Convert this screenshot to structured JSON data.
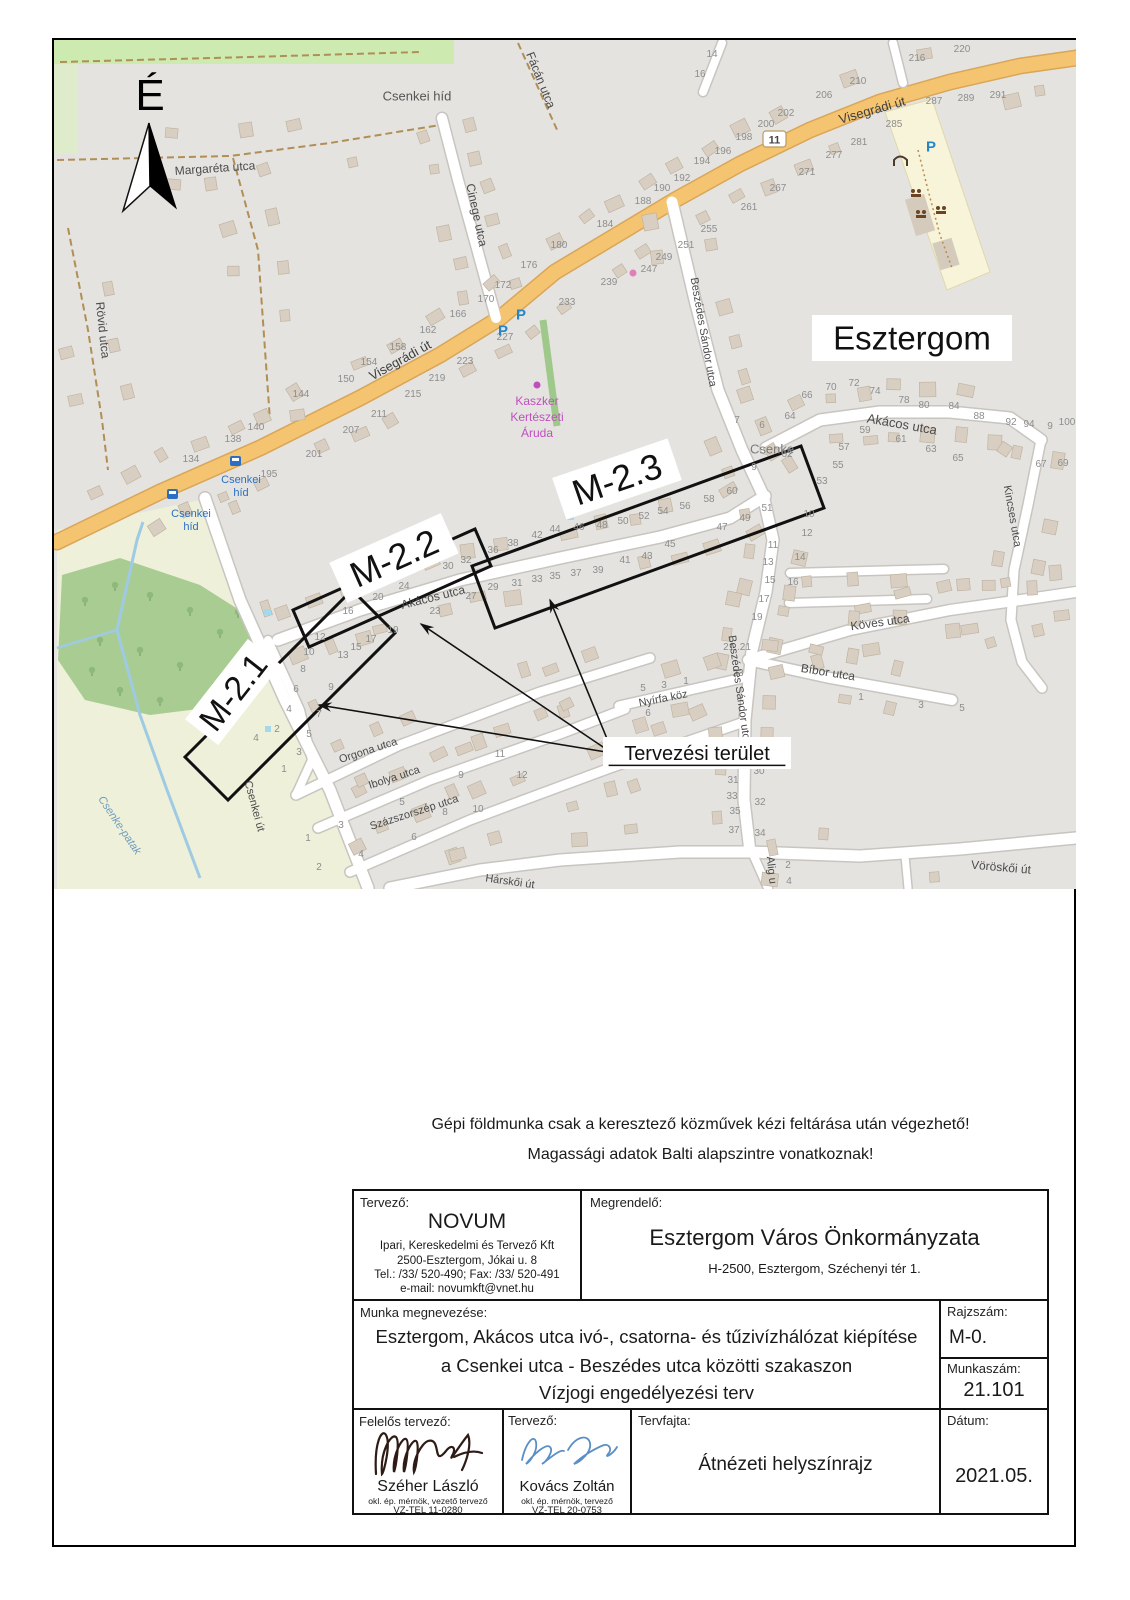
{
  "page": {
    "north_symbol": "É",
    "note_line1": "Gépi földmunka csak a keresztező közművek kézi feltárása után végezhető!",
    "note_line2": "Magassági adatok Balti alapszintre vonatkoznak!"
  },
  "map": {
    "route_shield": "11",
    "city_label": "Esztergom",
    "planning_area_label": "Tervezési terület",
    "section_labels": [
      "M-2.1",
      "M-2.2",
      "M-2.3"
    ],
    "labels": [
      {
        "t": "Margaréta utca",
        "x": 215,
        "y": 168,
        "r": -4,
        "s": 12
      },
      {
        "t": "Cinege utca",
        "x": 477,
        "y": 215,
        "r": 78,
        "s": 12
      },
      {
        "t": "Fácán utca",
        "x": 541,
        "y": 80,
        "r": 68,
        "s": 12
      },
      {
        "t": "Rövid utca",
        "x": 103,
        "y": 330,
        "r": 84,
        "s": 12
      },
      {
        "t": "Visegrádi út",
        "x": 400,
        "y": 360,
        "r": -29,
        "s": 13,
        "c": "#3f3f3f"
      },
      {
        "t": "Visegrádi út",
        "x": 872,
        "y": 110,
        "r": -16,
        "s": 13,
        "c": "#3f3f3f"
      },
      {
        "t": "Csenkei híd",
        "x": 417,
        "y": 96,
        "r": 0,
        "s": 13,
        "c": "#555"
      },
      {
        "t": "Akácos utca",
        "x": 433,
        "y": 597,
        "r": -14,
        "s": 12
      },
      {
        "t": "Akácos utca",
        "x": 902,
        "y": 424,
        "r": 10,
        "s": 13
      },
      {
        "t": "Beszédes Sándor utca",
        "x": 704,
        "y": 332,
        "r": 80,
        "s": 11
      },
      {
        "t": "Beszédes Sándor utca",
        "x": 740,
        "y": 690,
        "r": 82,
        "s": 11
      },
      {
        "t": "Kincses utca",
        "x": 1013,
        "y": 516,
        "r": 80,
        "s": 11
      },
      {
        "t": "Köves utca",
        "x": 880,
        "y": 622,
        "r": -8,
        "s": 12
      },
      {
        "t": "Bíbor utca",
        "x": 828,
        "y": 672,
        "r": 9,
        "s": 12
      },
      {
        "t": "Nyírfa köz",
        "x": 663,
        "y": 698,
        "r": -11,
        "s": 11
      },
      {
        "t": "Orgona utca",
        "x": 368,
        "y": 750,
        "r": -18,
        "s": 11
      },
      {
        "t": "Ibolya utca",
        "x": 394,
        "y": 777,
        "r": -18,
        "s": 11
      },
      {
        "t": "Százszorszép utca",
        "x": 414,
        "y": 812,
        "r": -18,
        "s": 11
      },
      {
        "t": "Csenkei út",
        "x": 255,
        "y": 806,
        "r": 75,
        "s": 11
      },
      {
        "t": "Vöröskői út",
        "x": 1001,
        "y": 867,
        "r": 5,
        "s": 12
      },
      {
        "t": "Hárskői út",
        "x": 510,
        "y": 881,
        "r": 8,
        "s": 11
      },
      {
        "t": "Alig u",
        "x": 772,
        "y": 870,
        "r": 84,
        "s": 11
      },
      {
        "t": "Csenke",
        "x": 772,
        "y": 449,
        "r": 0,
        "s": 13,
        "c": "#7a7a7a"
      },
      {
        "t": "Csenke-patak",
        "x": 120,
        "y": 825,
        "r": 56,
        "s": 11,
        "c": "#6d9cbd",
        "i": true
      },
      {
        "t": "Kaszker",
        "x": 537,
        "y": 401,
        "s": 12,
        "c": "#bf4fbf"
      },
      {
        "t": "Kertészeti",
        "x": 537,
        "y": 417,
        "s": 12,
        "c": "#bf4fbf"
      },
      {
        "t": "Áruda",
        "x": 537,
        "y": 433,
        "s": 12,
        "c": "#bf4fbf"
      },
      {
        "t": "Csenkei",
        "x": 241,
        "y": 479,
        "s": 11,
        "c": "#2a6fc4"
      },
      {
        "t": "híd",
        "x": 241,
        "y": 492,
        "s": 11,
        "c": "#2a6fc4"
      },
      {
        "t": "Csenkei",
        "x": 191,
        "y": 513,
        "s": 11,
        "c": "#2a6fc4"
      },
      {
        "t": "híd",
        "x": 191,
        "y": 526,
        "s": 11,
        "c": "#2a6fc4"
      },
      {
        "t": "P",
        "x": 503,
        "y": 330,
        "s": 15,
        "c": "#2586c7",
        "b": true
      },
      {
        "t": "P",
        "x": 521,
        "y": 314,
        "s": 15,
        "c": "#2586c7",
        "b": true
      },
      {
        "t": "P",
        "x": 931,
        "y": 146,
        "s": 15,
        "c": "#2586c7",
        "b": true
      },
      {
        "t": "Esztergom",
        "x": 912,
        "y": 338,
        "s": 33,
        "c": "#111",
        "bg": [
          200,
          46
        ]
      },
      {
        "t": "M-2.1",
        "x": 233,
        "y": 692,
        "r": -52,
        "s": 34,
        "c": "#111",
        "bg": [
          102,
          42
        ]
      },
      {
        "t": "M-2.2",
        "x": 394,
        "y": 558,
        "r": -24,
        "s": 36,
        "c": "#111",
        "bg": [
          122,
          44
        ]
      },
      {
        "t": "M-2.3",
        "x": 617,
        "y": 479,
        "r": -19,
        "s": 36,
        "c": "#111",
        "bg": [
          122,
          44
        ]
      },
      {
        "t": "Tervezési terület",
        "x": 697,
        "y": 753,
        "s": 20,
        "c": "#111",
        "bg": [
          188,
          32
        ],
        "u": true
      }
    ],
    "house_numbers": [
      [
        "216",
        917,
        61
      ],
      [
        "220",
        962,
        52
      ],
      [
        "210",
        858,
        84
      ],
      [
        "206",
        824,
        98
      ],
      [
        "202",
        786,
        116
      ],
      [
        "200",
        766,
        127
      ],
      [
        "198",
        744,
        140
      ],
      [
        "196",
        723,
        154
      ],
      [
        "194",
        702,
        164
      ],
      [
        "192",
        682,
        181
      ],
      [
        "190",
        662,
        191
      ],
      [
        "188",
        643,
        204
      ],
      [
        "184",
        605,
        227
      ],
      [
        "180",
        559,
        248
      ],
      [
        "176",
        529,
        268
      ],
      [
        "172",
        503,
        288
      ],
      [
        "170",
        486,
        302
      ],
      [
        "166",
        458,
        317
      ],
      [
        "162",
        428,
        333
      ],
      [
        "158",
        398,
        350
      ],
      [
        "154",
        369,
        365
      ],
      [
        "150",
        346,
        382
      ],
      [
        "144",
        301,
        397
      ],
      [
        "140",
        256,
        430
      ],
      [
        "138",
        233,
        442
      ],
      [
        "134",
        191,
        462
      ],
      [
        "287",
        934,
        104
      ],
      [
        "289",
        966,
        101
      ],
      [
        "291",
        998,
        98
      ],
      [
        "285",
        894,
        127
      ],
      [
        "281",
        859,
        145
      ],
      [
        "277",
        834,
        158
      ],
      [
        "271",
        807,
        175
      ],
      [
        "267",
        778,
        191
      ],
      [
        "261",
        749,
        210
      ],
      [
        "255",
        709,
        232
      ],
      [
        "251",
        686,
        248
      ],
      [
        "249",
        664,
        260
      ],
      [
        "247",
        649,
        272
      ],
      [
        "239",
        609,
        285
      ],
      [
        "233",
        567,
        305
      ],
      [
        "227",
        505,
        340
      ],
      [
        "223",
        465,
        364
      ],
      [
        "219",
        437,
        381
      ],
      [
        "215",
        413,
        397
      ],
      [
        "211",
        379,
        417
      ],
      [
        "207",
        351,
        433
      ],
      [
        "201",
        314,
        457
      ],
      [
        "195",
        269,
        477
      ],
      [
        "14",
        712,
        57
      ],
      [
        "16",
        700,
        77
      ],
      [
        "12",
        320,
        640
      ],
      [
        "16",
        348,
        614
      ],
      [
        "20",
        378,
        600
      ],
      [
        "24",
        404,
        589
      ],
      [
        "30",
        448,
        569
      ],
      [
        "32",
        466,
        563
      ],
      [
        "36",
        493,
        553
      ],
      [
        "38",
        513,
        546
      ],
      [
        "42",
        537,
        538
      ],
      [
        "44",
        555,
        532
      ],
      [
        "46",
        579,
        530
      ],
      [
        "48",
        602,
        528
      ],
      [
        "50",
        623,
        524
      ],
      [
        "52",
        644,
        519
      ],
      [
        "54",
        663,
        514
      ],
      [
        "56",
        685,
        509
      ],
      [
        "58",
        709,
        502
      ],
      [
        "60",
        732,
        494
      ],
      [
        "13",
        343,
        658
      ],
      [
        "15",
        356,
        650
      ],
      [
        "17",
        371,
        642
      ],
      [
        "19",
        393,
        633
      ],
      [
        "23",
        435,
        614
      ],
      [
        "27",
        471,
        599
      ],
      [
        "29",
        493,
        590
      ],
      [
        "31",
        517,
        586
      ],
      [
        "33",
        537,
        582
      ],
      [
        "35",
        555,
        579
      ],
      [
        "37",
        576,
        576
      ],
      [
        "39",
        598,
        573
      ],
      [
        "41",
        625,
        563
      ],
      [
        "43",
        647,
        559
      ],
      [
        "45",
        670,
        547
      ],
      [
        "47",
        722,
        530
      ],
      [
        "49",
        745,
        521
      ],
      [
        "51",
        767,
        511
      ],
      [
        "64",
        790,
        419
      ],
      [
        "66",
        807,
        398
      ],
      [
        "70",
        831,
        390
      ],
      [
        "72",
        854,
        386
      ],
      [
        "74",
        875,
        394
      ],
      [
        "78",
        904,
        403
      ],
      [
        "80",
        924,
        408
      ],
      [
        "84",
        954,
        409
      ],
      [
        "88",
        979,
        419
      ],
      [
        "92",
        1011,
        425
      ],
      [
        "94",
        1029,
        427
      ],
      [
        "9",
        1050,
        429
      ],
      [
        "100",
        1067,
        425
      ],
      [
        "6",
        762,
        428
      ],
      [
        "7",
        737,
        423
      ],
      [
        "62",
        787,
        457
      ],
      [
        "9",
        754,
        470
      ],
      [
        "53",
        822,
        484
      ],
      [
        "55",
        838,
        468
      ],
      [
        "57",
        844,
        450
      ],
      [
        "59",
        865,
        433
      ],
      [
        "61",
        901,
        442
      ],
      [
        "63",
        931,
        452
      ],
      [
        "65",
        958,
        461
      ],
      [
        "67",
        1041,
        467
      ],
      [
        "69",
        1063,
        466
      ],
      [
        "10",
        809,
        517
      ],
      [
        "12",
        807,
        536
      ],
      [
        "14",
        800,
        560
      ],
      [
        "16",
        793,
        585
      ],
      [
        "11",
        773,
        548
      ],
      [
        "13",
        768,
        565
      ],
      [
        "15",
        770,
        583
      ],
      [
        "17",
        764,
        602
      ],
      [
        "19",
        757,
        620
      ],
      [
        "21..21",
        737,
        650
      ],
      [
        "23",
        738,
        676
      ],
      [
        "30",
        759,
        774
      ],
      [
        "31",
        733,
        783
      ],
      [
        "33",
        732,
        799
      ],
      [
        "35",
        735,
        814
      ],
      [
        "37",
        734,
        833
      ],
      [
        "32",
        760,
        805
      ],
      [
        "34",
        760,
        836
      ],
      [
        "1",
        861,
        700
      ],
      [
        "3",
        921,
        708
      ],
      [
        "5",
        962,
        711
      ],
      [
        "5",
        643,
        691
      ],
      [
        "3",
        664,
        688
      ],
      [
        "1",
        686,
        684
      ],
      [
        "6",
        648,
        716
      ],
      [
        "10",
        309,
        655
      ],
      [
        "8",
        303,
        672
      ],
      [
        "6",
        296,
        692
      ],
      [
        "9",
        331,
        690
      ],
      [
        "4",
        289,
        712
      ],
      [
        "7",
        319,
        717
      ],
      [
        "2",
        277,
        732
      ],
      [
        "5",
        309,
        737
      ],
      [
        "3",
        299,
        755
      ],
      [
        "1",
        284,
        772
      ],
      [
        "4",
        256,
        741
      ],
      [
        "1",
        308,
        841
      ],
      [
        "3",
        341,
        828
      ],
      [
        "5",
        402,
        805
      ],
      [
        "8",
        445,
        815
      ],
      [
        "10",
        478,
        812
      ],
      [
        "6",
        414,
        840
      ],
      [
        "4",
        361,
        857
      ],
      [
        "2",
        319,
        870
      ],
      [
        "11",
        500,
        757
      ],
      [
        "12",
        522,
        778
      ],
      [
        "9",
        461,
        778
      ],
      [
        "2",
        788,
        868
      ],
      [
        "4",
        789,
        884
      ]
    ]
  },
  "title_block": {
    "tervezo": {
      "label": "Tervező:",
      "name": "NOVUM",
      "line1": "Ipari, Kereskedelmi és Tervező Kft",
      "line2": "2500-Esztergom, Jókai u. 8",
      "line3": "Tel.: /33/ 520-490; Fax: /33/ 520-491",
      "line4": "e-mail: novumkft@vnet.hu"
    },
    "megrendelo": {
      "label": "Megrendelő:",
      "name": "Esztergom Város Önkormányzata",
      "address": "H-2500, Esztergom, Széchenyi tér 1."
    },
    "munka": {
      "label": "Munka megnevezése:",
      "line1": "Esztergom, Akácos utca ivó-, csatorna- és tűzivízhálózat kiépítése",
      "line2": "a Csenkei utca - Beszédes utca közötti szakaszon",
      "line3": "Vízjogi engedélyezési terv"
    },
    "rajzszam": {
      "label": "Rajzszám:",
      "value": "M-0."
    },
    "munkaszam": {
      "label": "Munkaszám:",
      "value": "21.101"
    },
    "felelos": {
      "label": "Felelős tervező:",
      "name": "Széher László",
      "title": "okl. ép. mérnök, vezető tervező",
      "reg": "VZ-TEL 11-0280"
    },
    "tervezo2": {
      "label": "Tervező:",
      "name": "Kovács Zoltán",
      "title": "okl. ép. mérnök, tervező",
      "reg": "VZ-TEL 20-0753"
    },
    "tervfajta": {
      "label": "Tervfajta:",
      "value": "Átnézeti helyszínrajz"
    },
    "datum": {
      "label": "Dátum:",
      "value": "2021.05."
    }
  }
}
